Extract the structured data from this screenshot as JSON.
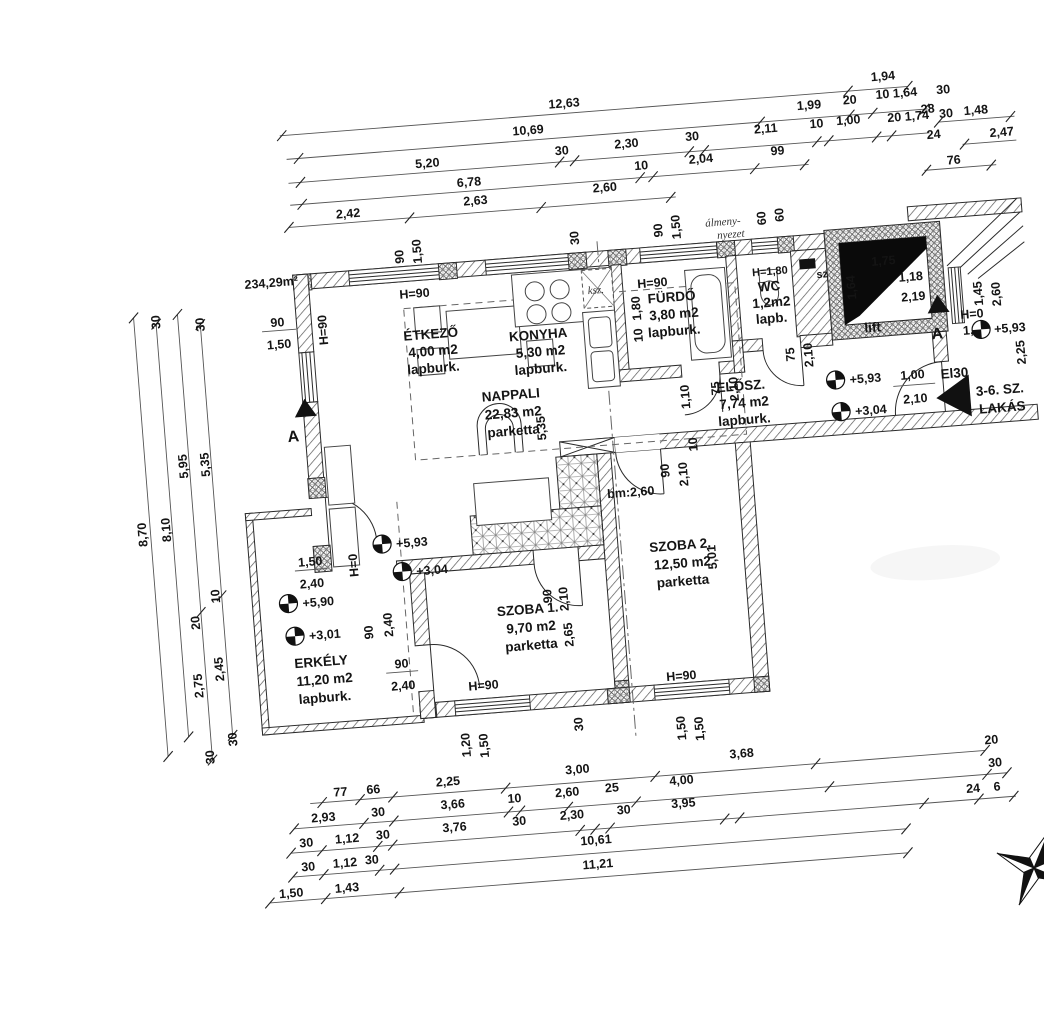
{
  "meta": {
    "area_total": "234,29m²"
  },
  "rooms": {
    "etkezo": {
      "name": "ÉTKEZŐ",
      "area": "4,00 m2",
      "floor": "lapburk."
    },
    "konyha": {
      "name": "KONYHA",
      "area": "5,30 m2",
      "floor": "lapburk."
    },
    "furdo": {
      "name": "FÜRDŐ",
      "area": "3,80 m2",
      "floor": "lapburk."
    },
    "wc": {
      "name": "WC",
      "area": "1,2m2",
      "floor": "lapb."
    },
    "elosz": {
      "name": "ELŐSZ.",
      "area": "7,74 m2",
      "floor": "lapburk."
    },
    "nappali": {
      "name": "NAPPALI",
      "area": "22,83 m2",
      "floor": "parketta"
    },
    "szoba1": {
      "name": "SZOBA 1.",
      "area": "9,70 m2",
      "floor": "parketta"
    },
    "szoba2": {
      "name": "SZOBA 2.",
      "area": "12,50 m2",
      "floor": "parketta"
    },
    "erkely": {
      "name": "ERKÉLY",
      "area": "11,20 m2",
      "floor": "lapburk."
    },
    "lift": {
      "name": "lift"
    },
    "lakas": {
      "line1": "3-6. SZ.",
      "line2": "LAKÁS",
      "door": "El30"
    }
  },
  "levels": {
    "nappali_a": "+5,93",
    "nappali_b": "+3,04",
    "erkely_a": "+5,90",
    "erkely_b": "+3,01",
    "elosz_a": "+5,93",
    "elosz_b": "+3,04",
    "stair_a": "+5,93"
  },
  "sections": {
    "left": "A",
    "right": "A"
  },
  "notes": {
    "ceiling1": "álmeny-",
    "ceiling2": "nyezet",
    "flue": "ksz.",
    "shaft": "sz",
    "ceiling_h": "bm:2,60"
  },
  "heights": {
    "h90": "H=90",
    "h0": "H=0",
    "h180": "H=1,80"
  },
  "dims": {
    "top1": [
      "12,63",
      "1,94"
    ],
    "top2": [
      "10,69",
      "1,99",
      "20",
      "10 1,64",
      "30",
      "28"
    ],
    "top3": [
      "5,20",
      "30",
      "2,30",
      "30",
      "2,11",
      "10",
      "1,00",
      "20 1,74",
      "30",
      "24"
    ],
    "top4": [
      "6,78",
      "10",
      "2,04",
      "99",
      "76"
    ],
    "top5": [
      "2,42",
      "2,63",
      "2,60"
    ],
    "topright": [
      "1,48",
      "2,47"
    ],
    "left": [
      "30",
      "30",
      "8,70",
      "8,10",
      "5,95",
      "5,35",
      "10",
      "20",
      "2,75",
      "2,45",
      "30",
      "30"
    ],
    "bottom1": [
      "77",
      "66",
      "2,25",
      "3,00",
      "3,68",
      "20"
    ],
    "bottom2": [
      "2,93",
      "30",
      "3,66",
      "10",
      "2,60",
      "25",
      "4,00",
      "30"
    ],
    "bottom3": [
      "30",
      "1,12",
      "30",
      "3,76",
      "30",
      "2,30",
      "30",
      "3,95",
      "24",
      "6"
    ],
    "bottom4": [
      "30",
      "1,12",
      "30",
      "10,61"
    ],
    "bottom5": [
      "1,50",
      "1,43",
      "11,21"
    ],
    "lift": [
      "1,75",
      "1,64",
      "1,18",
      "2,19"
    ],
    "right": [
      "1,45",
      "2,60",
      "1,55",
      "2,25"
    ],
    "win_etkezo": [
      "90",
      "1,50"
    ],
    "win_furdo": [
      "90",
      "1,50"
    ],
    "win_30": "30",
    "win_wc": [
      "60",
      "60"
    ],
    "win_left": [
      "90",
      "1,50"
    ],
    "furdo_wall": [
      "10",
      "1,80"
    ],
    "elosz": [
      "1,10",
      "75",
      "2,10",
      "75",
      "2,10"
    ],
    "szoba2_door": [
      "90",
      "2,10",
      "10"
    ],
    "szoba2_h": "5,01",
    "szoba1_door": [
      "90",
      "2,10"
    ],
    "szoba1_h": "2,65",
    "nappali_h": "5,35",
    "door_balcony": [
      "1,50",
      "2,40"
    ],
    "door_sz1a": [
      "90",
      "2,40"
    ],
    "door_sz1b": [
      "90",
      "2,40"
    ],
    "door_lakas": [
      "1,00",
      "2,10"
    ],
    "win_sz1": [
      "1,20",
      "1,50"
    ],
    "pier_30": "30",
    "win_sz2": [
      "1,50",
      "1,50"
    ]
  }
}
